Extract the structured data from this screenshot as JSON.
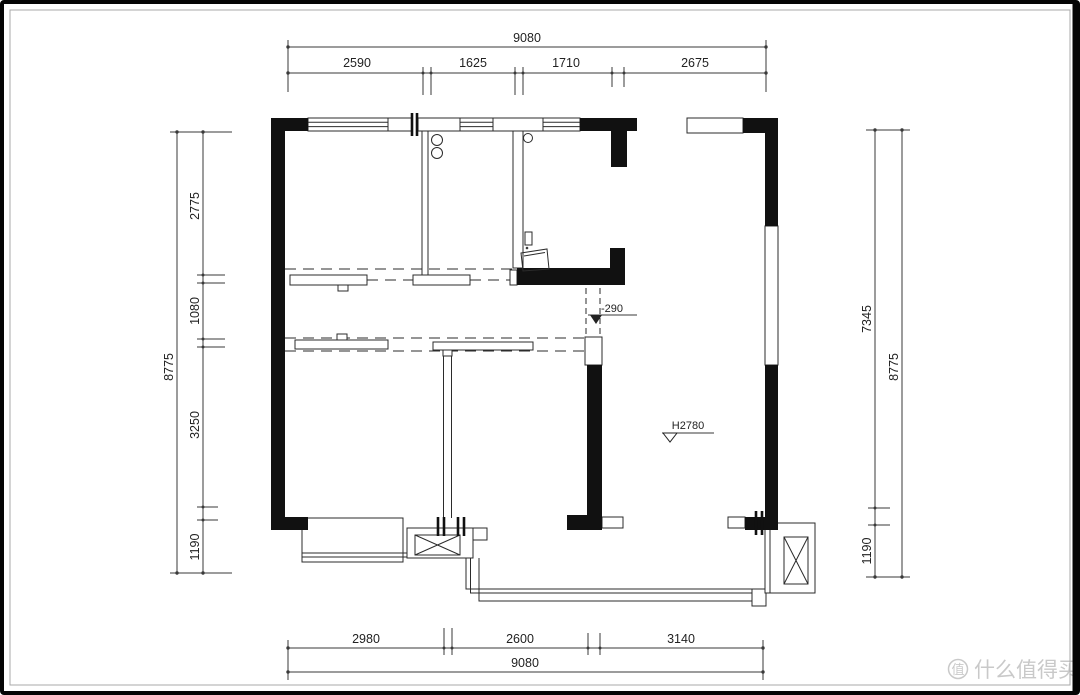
{
  "drawing": {
    "kind": "apartment-floor-plan",
    "units": "mm"
  },
  "dims": {
    "top": {
      "total": "9080",
      "segments": [
        "2590",
        "1625",
        "1710",
        "2675"
      ]
    },
    "bottom": {
      "total": "9080",
      "segments": [
        "2980",
        "2600",
        "3140"
      ]
    },
    "left": {
      "total": "8775",
      "segments": [
        "2775",
        "1080",
        "3250",
        "1190"
      ]
    },
    "right": {
      "overall": "8775",
      "upper": "7345",
      "lower": "1190"
    }
  },
  "annotations": {
    "ceiling_height": "H2780",
    "floor_level": "-290"
  },
  "watermark": {
    "logo_char": "值",
    "text": "什么值得买"
  },
  "colors": {
    "wall": "#111111",
    "line": "#2b2b2b",
    "dim_text": "#222222",
    "watermark": "#c9c9c9",
    "background": "#ffffff"
  }
}
